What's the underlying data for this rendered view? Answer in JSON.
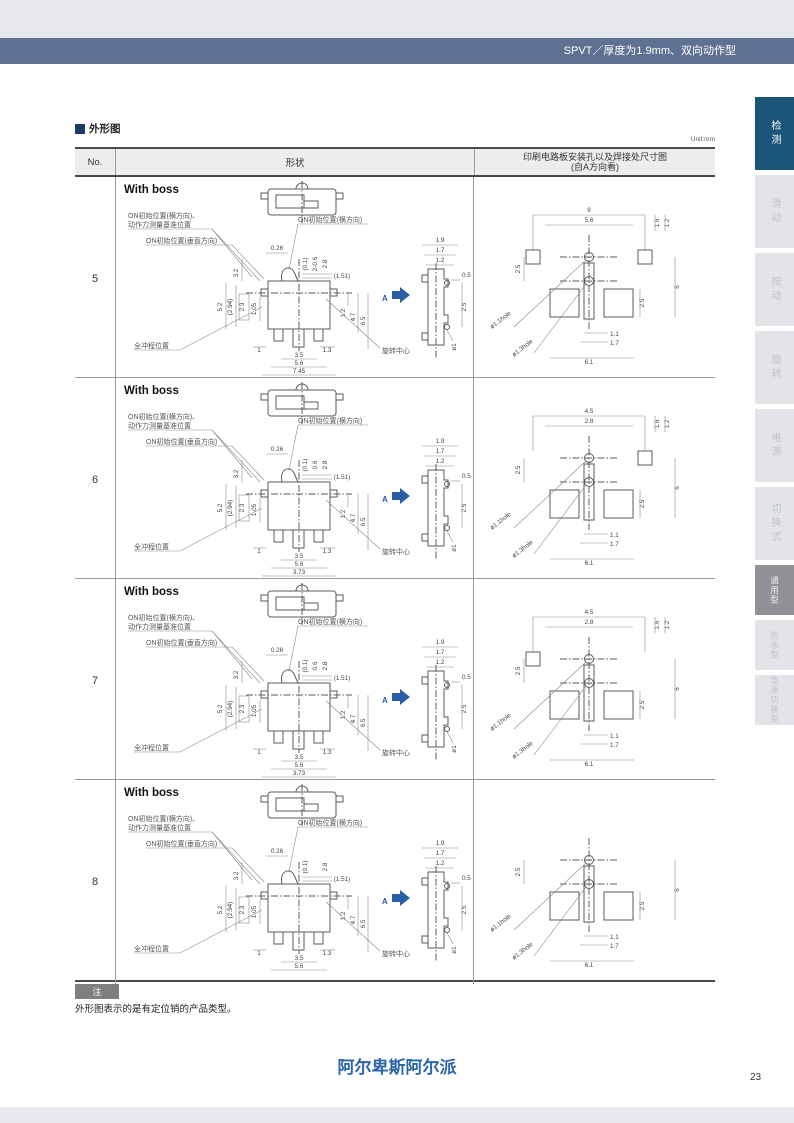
{
  "page": {
    "top_title": "SPVT／厚度为1.9mm、双向动作型",
    "section_title": "外形图",
    "unit_label": "Unit:mm",
    "note_badge": "注",
    "note_text": "外形图表示的是有定位销的产品类型。",
    "brand": "阿尔卑斯阿尔派",
    "page_number": "23"
  },
  "sidebar": {
    "tabs": [
      {
        "label": "检测",
        "state": "active-primary"
      },
      {
        "label": "滑动",
        "state": ""
      },
      {
        "label": "按动",
        "state": ""
      },
      {
        "label": "旋转",
        "state": ""
      },
      {
        "label": "电源",
        "state": ""
      },
      {
        "label": "切换式",
        "state": ""
      },
      {
        "label": "通用型",
        "state": "active-secondary"
      },
      {
        "label": "防水型",
        "state": ""
      },
      {
        "label": "急速切换型",
        "state": ""
      }
    ]
  },
  "table": {
    "headers": {
      "no": "No.",
      "shape": "形状",
      "pcb_line1": "印刷电路板安装孔以及焊接处尺寸图",
      "pcb_line2": "(自A方向看)"
    },
    "labels": {
      "on_ref_line1": "ON初始位置(横方向)、",
      "on_ref_line2": "动作力测量基准位置",
      "on_vertical": "ON初始位置(垂直方向)",
      "on_lateral": "ON初始位置(横方向)",
      "full_stroke": "全冲程位置",
      "rotation_center": "旋转中心",
      "view_label": "A"
    },
    "rows": [
      {
        "no": "5",
        "shape_label": "With boss",
        "variant": "v5",
        "front": {
          "d026": "0.26",
          "d01": "(0.1)",
          "d06": "2-0.6",
          "d28": "2.8",
          "d151": "(1.51)",
          "d32": "3.2",
          "d52": "5.2",
          "d294": "(2.94)",
          "d23": "2.3",
          "d105": "1.05",
          "d1": "1",
          "d13": "1.3",
          "d12": "1.2",
          "d47": "4.7",
          "d65": "6.5",
          "w1": "3.5",
          "w2": "5.6",
          "w3": "7.45"
        },
        "side": {
          "d19": "1.9",
          "d17": "1.7",
          "d12": "1.2",
          "d05": "0.5",
          "d25": "2.5",
          "dia": "ø1"
        },
        "pcb": {
          "top1": "9",
          "top2": "5.6",
          "d16": "1.6",
          "d12": "1.2",
          "left": "2.5",
          "height": "6",
          "right": "2.5",
          "d11": "1.1",
          "d17": "1.7",
          "bottom": "6.1",
          "hole1": "ø1.1hole",
          "hole2": "ø1.3hole"
        }
      },
      {
        "no": "6",
        "shape_label": "With boss",
        "variant": "v6",
        "front": {
          "d026": "0.26",
          "d01": "(0.1)",
          "d06": "0.6",
          "d28": "2.8",
          "d151": "(1.51)",
          "d32": "3.2",
          "d52": "5.2",
          "d294": "(2.94)",
          "d23": "2.3",
          "d105": "1.05",
          "d1": "1",
          "d13": "1.3",
          "d12": "1.2",
          "d47": "4.7",
          "d65": "6.5",
          "w1": "3.5",
          "w2": "5.6",
          "w3": "3.73"
        },
        "side": {
          "d19": "1.9",
          "d17": "1.7",
          "d12": "1.2",
          "d05": "0.5",
          "d25": "2.5",
          "dia": "ø1"
        },
        "pcb": {
          "top1": "4.5",
          "top2": "2.8",
          "d16": "1.6",
          "d12": "1.2",
          "left": "2.5",
          "height": "6",
          "right": "2.5",
          "d11": "1.1",
          "d17": "1.7",
          "bottom": "6.1",
          "hole1": "ø1.1hole",
          "hole2": "ø1.3hole"
        }
      },
      {
        "no": "7",
        "shape_label": "With boss",
        "variant": "v7",
        "front": {
          "d026": "0.26",
          "d01": "(0.1)",
          "d06": "0.6",
          "d28": "2.8",
          "d151": "(1.51)",
          "d32": "3.2",
          "d52": "5.2",
          "d294": "(2.94)",
          "d23": "2.3",
          "d105": "1.05",
          "d1": "1",
          "d13": "1.3",
          "d12": "1.2",
          "d47": "4.7",
          "d65": "6.5",
          "w1": "3.5",
          "w2": "5.6",
          "w3": "3.73"
        },
        "side": {
          "d19": "1.9",
          "d17": "1.7",
          "d12": "1.2",
          "d05": "0.5",
          "d25": "2.5",
          "dia": "ø1"
        },
        "pcb": {
          "top1": "4.5",
          "top2": "2.8",
          "d16": "1.6",
          "d12": "1.2",
          "left": "2.5",
          "height": "6",
          "right": "2.5",
          "d11": "1.1",
          "d17": "1.7",
          "bottom": "6.1",
          "hole1": "ø1.1hole",
          "hole2": "ø1.3hole"
        }
      },
      {
        "no": "8",
        "shape_label": "With boss",
        "variant": "v8",
        "front": {
          "d026": "0.26",
          "d01": "(0.1)",
          "d28": "2.8",
          "d151": "(1.51)",
          "d32": "3.2",
          "d52": "5.2",
          "d294": "(2.94)",
          "d23": "2.3",
          "d105": "1.05",
          "d1": "1",
          "d13": "1.3",
          "d12": "1.2",
          "d47": "4.7",
          "d65": "6.5",
          "w1": "3.5",
          "w2": "5.6"
        },
        "side": {
          "d19": "1.9",
          "d17": "1.7",
          "d12": "1.2",
          "d05": "0.5",
          "d25": "2.5",
          "dia": "ø1"
        },
        "pcb": {
          "left": "2.5",
          "height": "6",
          "right": "2.5",
          "d11": "1.1",
          "d17": "1.7",
          "bottom": "6.1",
          "hole1": "ø1.1hole",
          "hole2": "ø1.3hole"
        }
      }
    ]
  }
}
